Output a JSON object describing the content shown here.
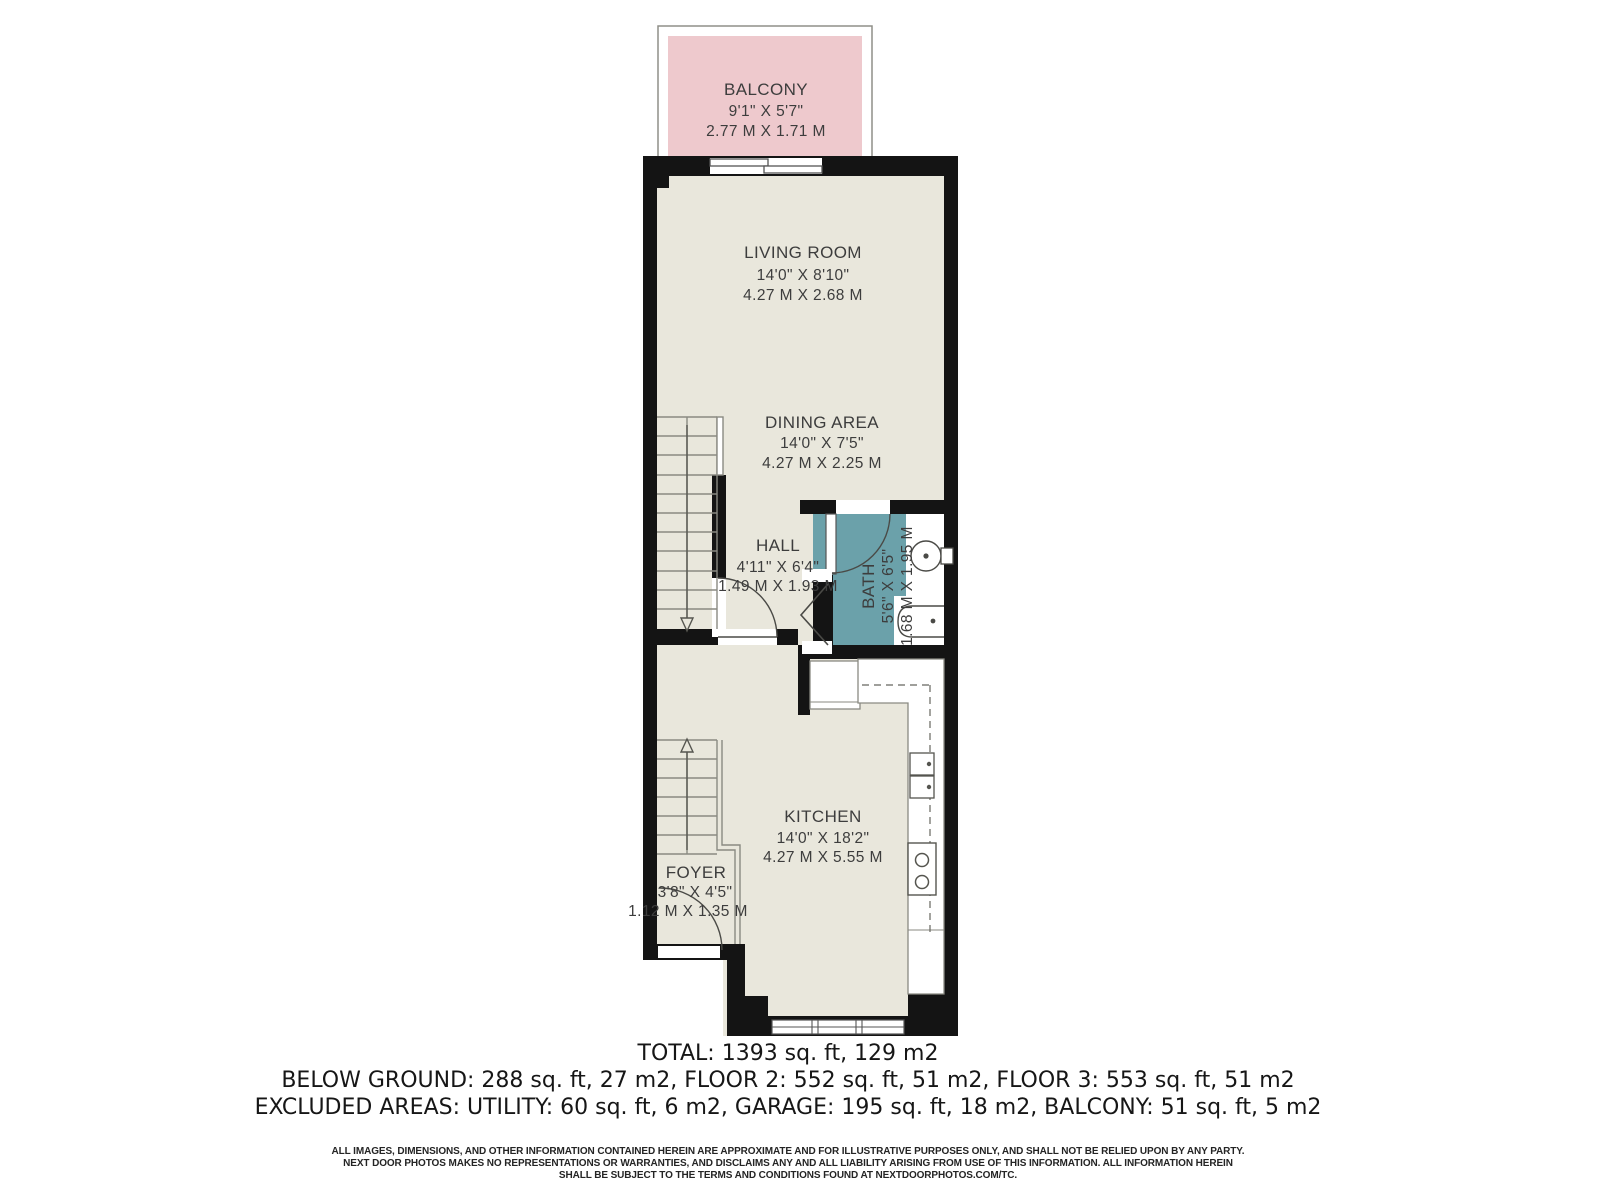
{
  "rooms": {
    "balcony": {
      "name": "BALCONY",
      "imperial": "9'1\" X 5'7\"",
      "metric": "2.77 M X 1.71 M"
    },
    "living_room": {
      "name": "LIVING ROOM",
      "imperial": "14'0\" X 8'10\"",
      "metric": "4.27 M X 2.68 M"
    },
    "dining_area": {
      "name": "DINING AREA",
      "imperial": "14'0\" X 7'5\"",
      "metric": "4.27 M X 2.25 M"
    },
    "hall": {
      "name": "HALL",
      "imperial": "4'11\" X 6'4\"",
      "metric": "1.49 M X 1.93 M"
    },
    "bath": {
      "name": "BATH",
      "imperial": "5'6\" X 6'5\"",
      "metric": "1.68 M X 1.95 M"
    },
    "kitchen": {
      "name": "KITCHEN",
      "imperial": "14'0\" X 18'2\"",
      "metric": "4.27 M X 5.55 M"
    },
    "foyer": {
      "name": "FOYER",
      "imperial": "3'8\" X 4'5\"",
      "metric": "1.12 M X 1.35 M"
    }
  },
  "summary": {
    "total": "TOTAL: 1393 sq. ft, 129 m2",
    "floors": "BELOW GROUND: 288 sq. ft, 27 m2, FLOOR 2: 552 sq. ft, 51 m2, FLOOR 3: 553 sq. ft, 51 m2",
    "excluded": "EXCLUDED AREAS: UTILITY: 60 sq. ft, 6 m2, GARAGE: 195 sq. ft, 18 m2, BALCONY: 51 sq. ft, 5 m2"
  },
  "disclaimer": {
    "line1": "ALL IMAGES, DIMENSIONS, AND OTHER INFORMATION CONTAINED HEREIN ARE APPROXIMATE AND FOR ILLUSTRATIVE PURPOSES ONLY, AND SHALL NOT BE RELIED UPON BY ANY PARTY.",
    "line2": "NEXT DOOR PHOTOS MAKES NO REPRESENTATIONS OR WARRANTIES, AND DISCLAIMS ANY AND ALL LIABILITY ARISING FROM USE OF THIS INFORMATION. ALL INFORMATION HEREIN",
    "line3": "SHALL BE SUBJECT TO THE TERMS AND CONDITIONS FOUND AT NEXTDOORPHOTOS.COM/TC."
  },
  "colors": {
    "wall": "#141414",
    "floor": "#e9e7dc",
    "balcony": "#eec9cd",
    "bath": "#6ba1aa"
  }
}
